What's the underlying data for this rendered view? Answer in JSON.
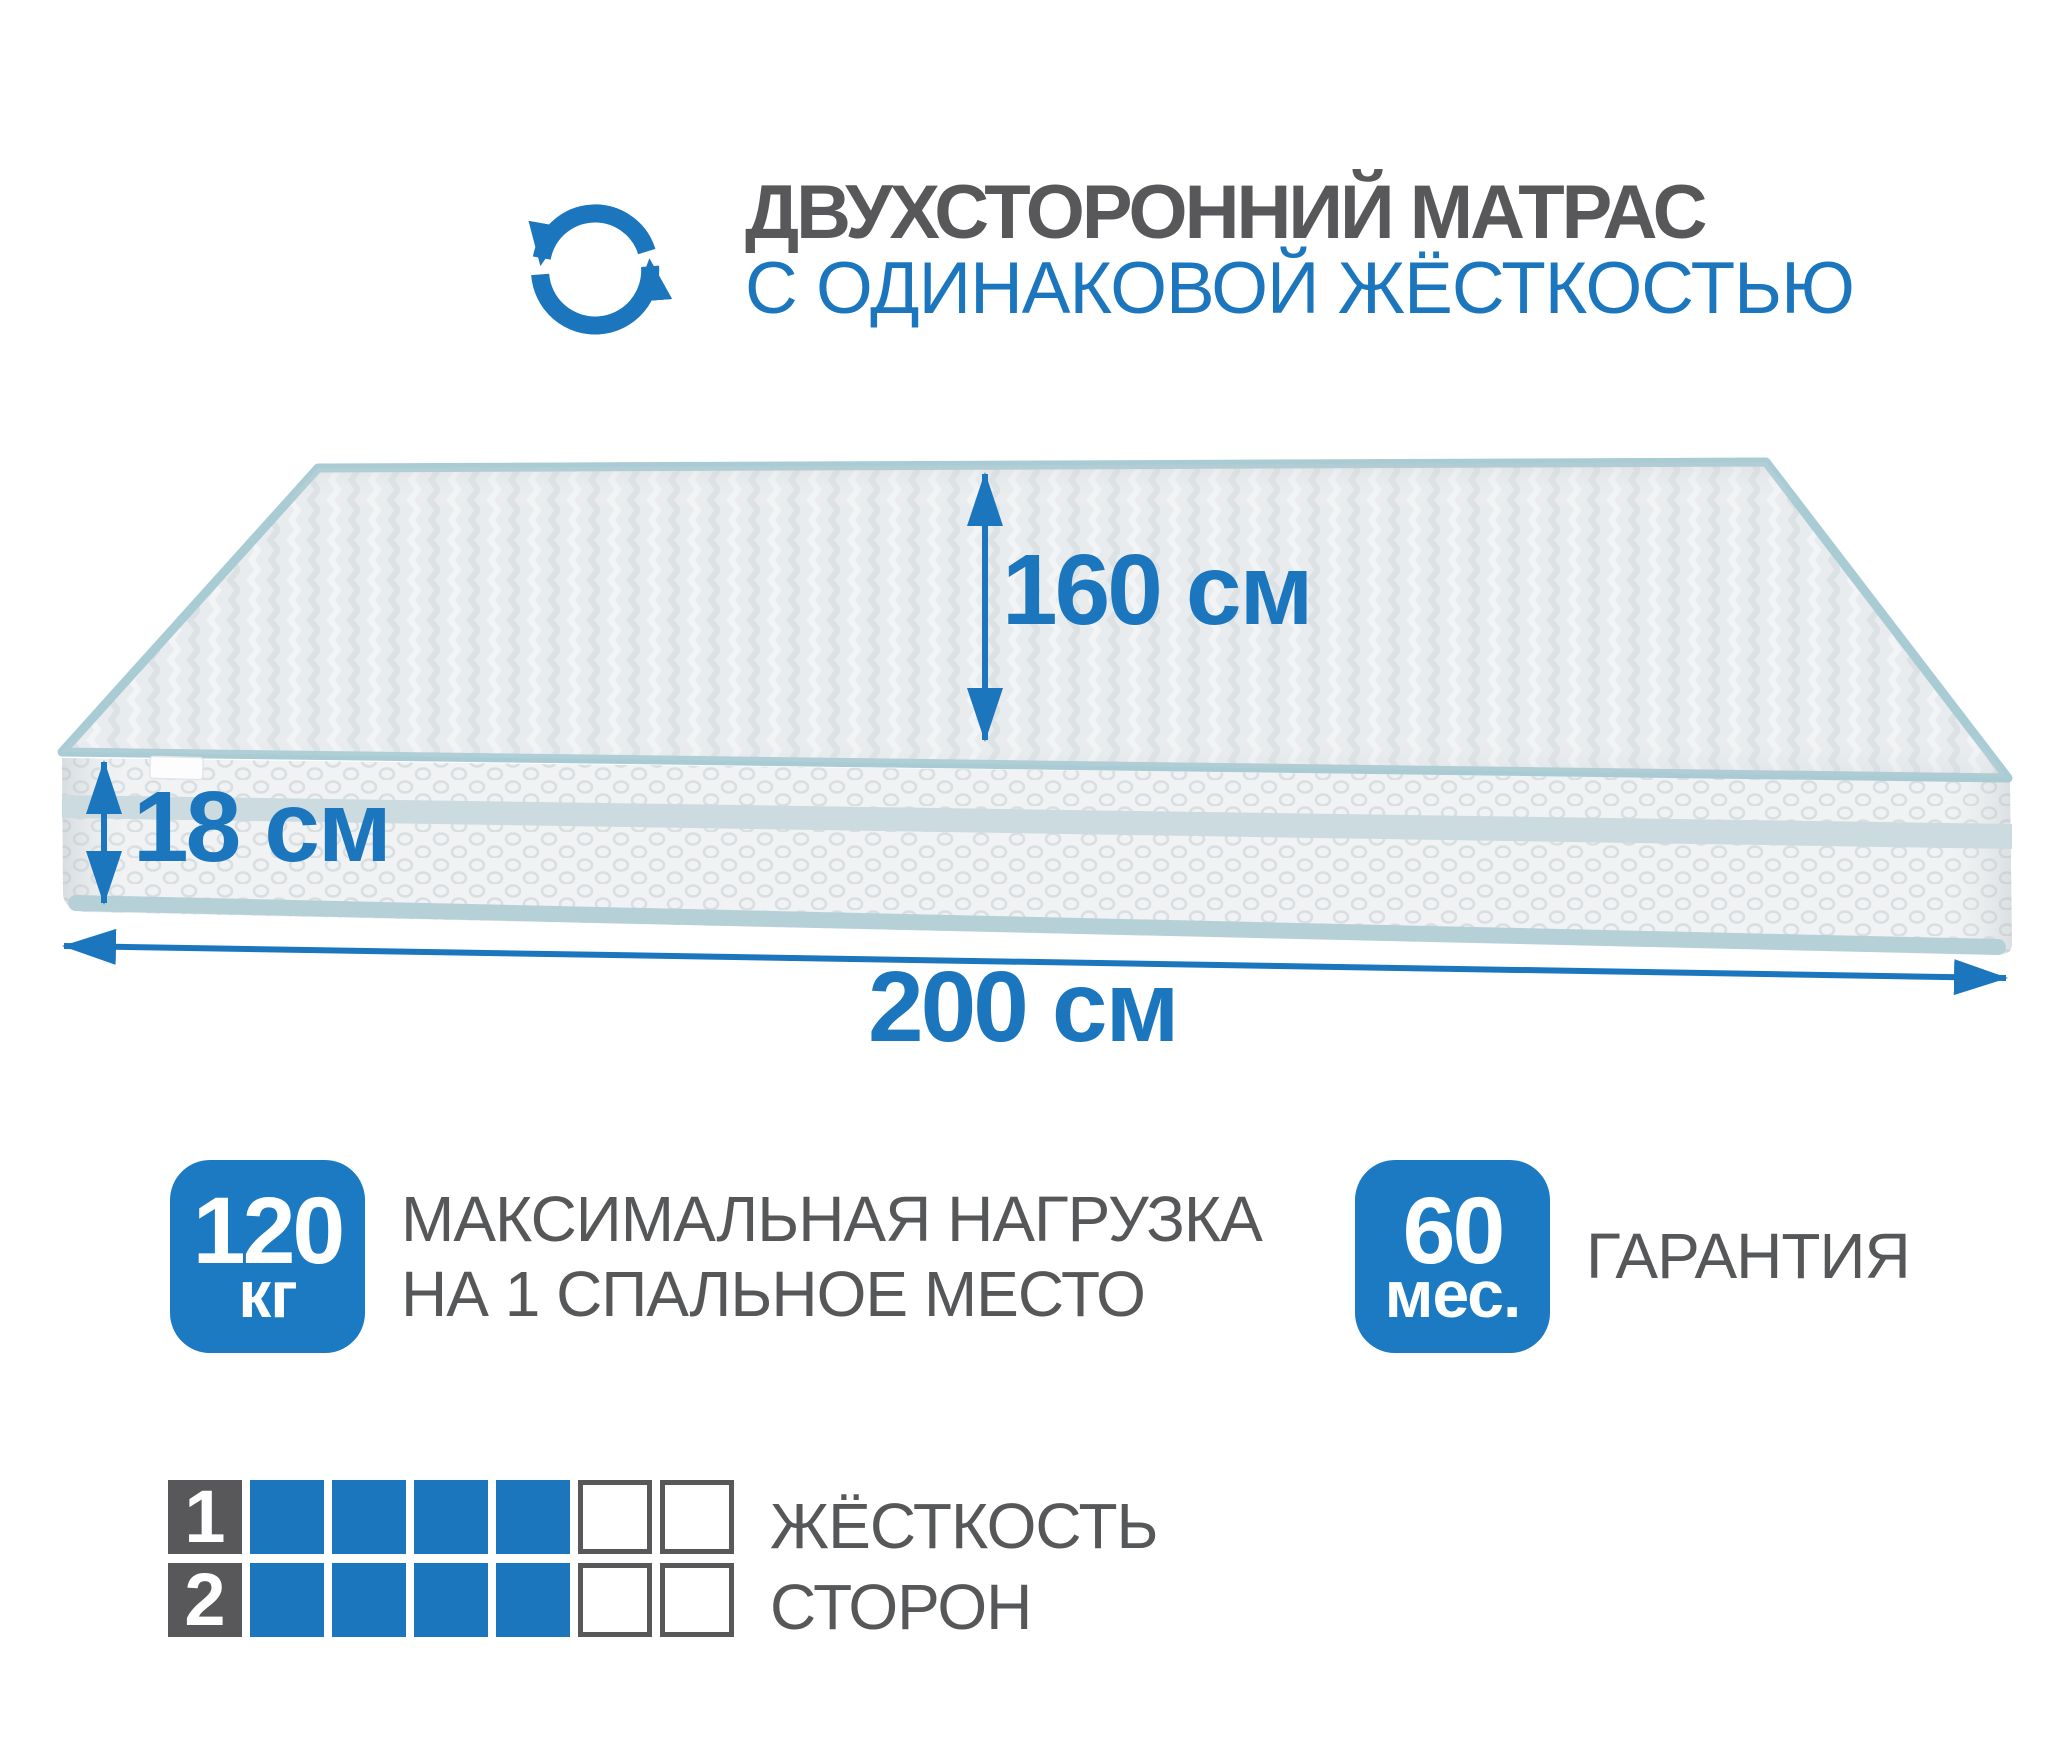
{
  "colors": {
    "accent": "#1b76bd",
    "badge": "#1b7ac1",
    "dark_text": "#58585a",
    "label_gray": "#565759",
    "piping_teal": "#a9cbd3"
  },
  "header": {
    "icon": "rotate-arrows-icon",
    "title_line1": "ДВУХСТОРОННИЙ МАТРАС",
    "title_line2": "С ОДИНАКОВОЙ ЖЁСТКОСТЬЮ"
  },
  "dimensions": {
    "width": {
      "value": "160",
      "unit": "см"
    },
    "height": {
      "value": "18",
      "unit": "см"
    },
    "length": {
      "value": "200",
      "unit": "см"
    }
  },
  "badges": {
    "max_load": {
      "value": "120",
      "unit": "кг",
      "label_line1": "МАКСИМАЛЬНАЯ НАГРУЗКА",
      "label_line2": "НА 1 СПАЛЬНОЕ МЕСТО"
    },
    "warranty": {
      "value": "60",
      "unit": "мес.",
      "label": "ГАРАНТИЯ"
    }
  },
  "firmness_scale": {
    "rows": [
      {
        "number": "1",
        "filled": 4,
        "total": 6
      },
      {
        "number": "2",
        "filled": 4,
        "total": 6
      }
    ],
    "label_line1": "ЖЁСТКОСТЬ",
    "label_line2": "СТОРОН"
  }
}
